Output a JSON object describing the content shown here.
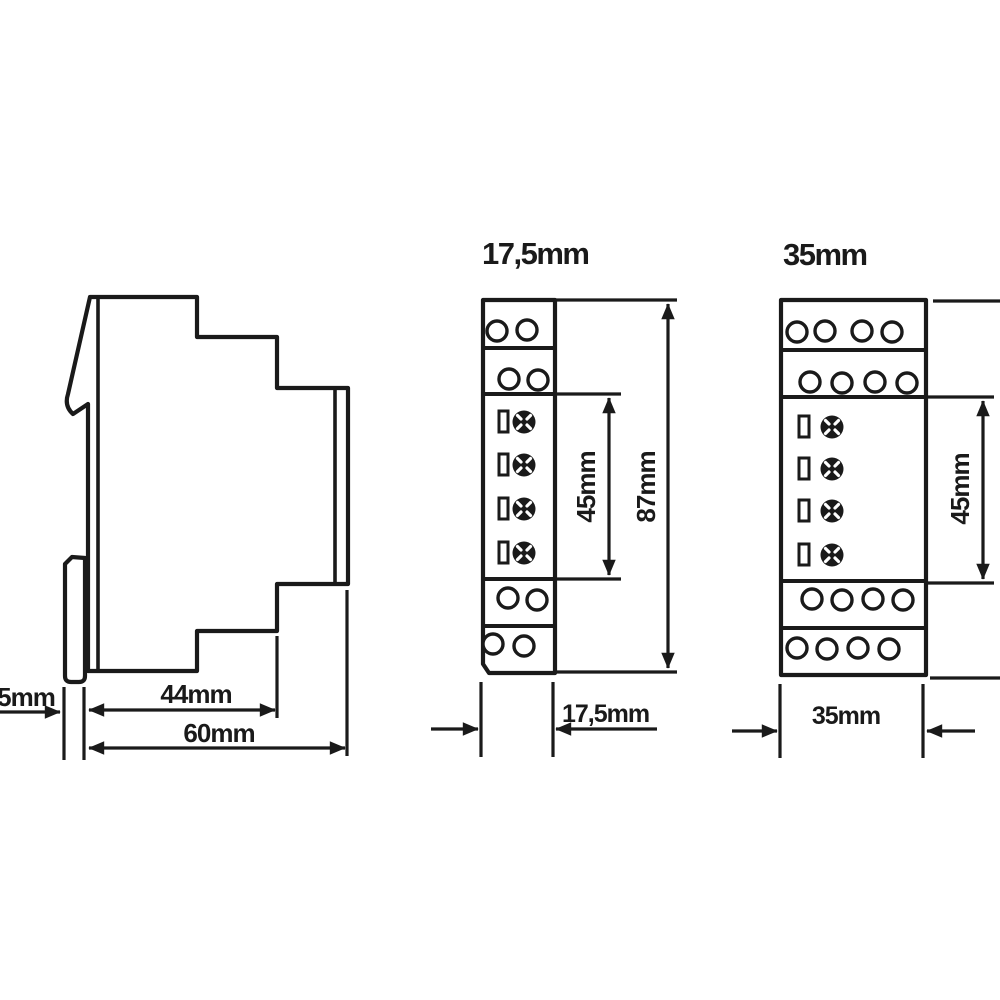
{
  "colors": {
    "ink": "#1a1a1a",
    "paper": "#ffffff"
  },
  "labels": {
    "side_clip_depth": "5mm",
    "side_body_depth": "44mm",
    "side_total_depth": "60mm",
    "narrow_title": "17,5mm",
    "narrow_center_height": "45mm",
    "narrow_total_height": "87mm",
    "narrow_width": "17,5mm",
    "wide_title": "35mm",
    "wide_center_height": "45mm",
    "wide_width": "35mm"
  }
}
